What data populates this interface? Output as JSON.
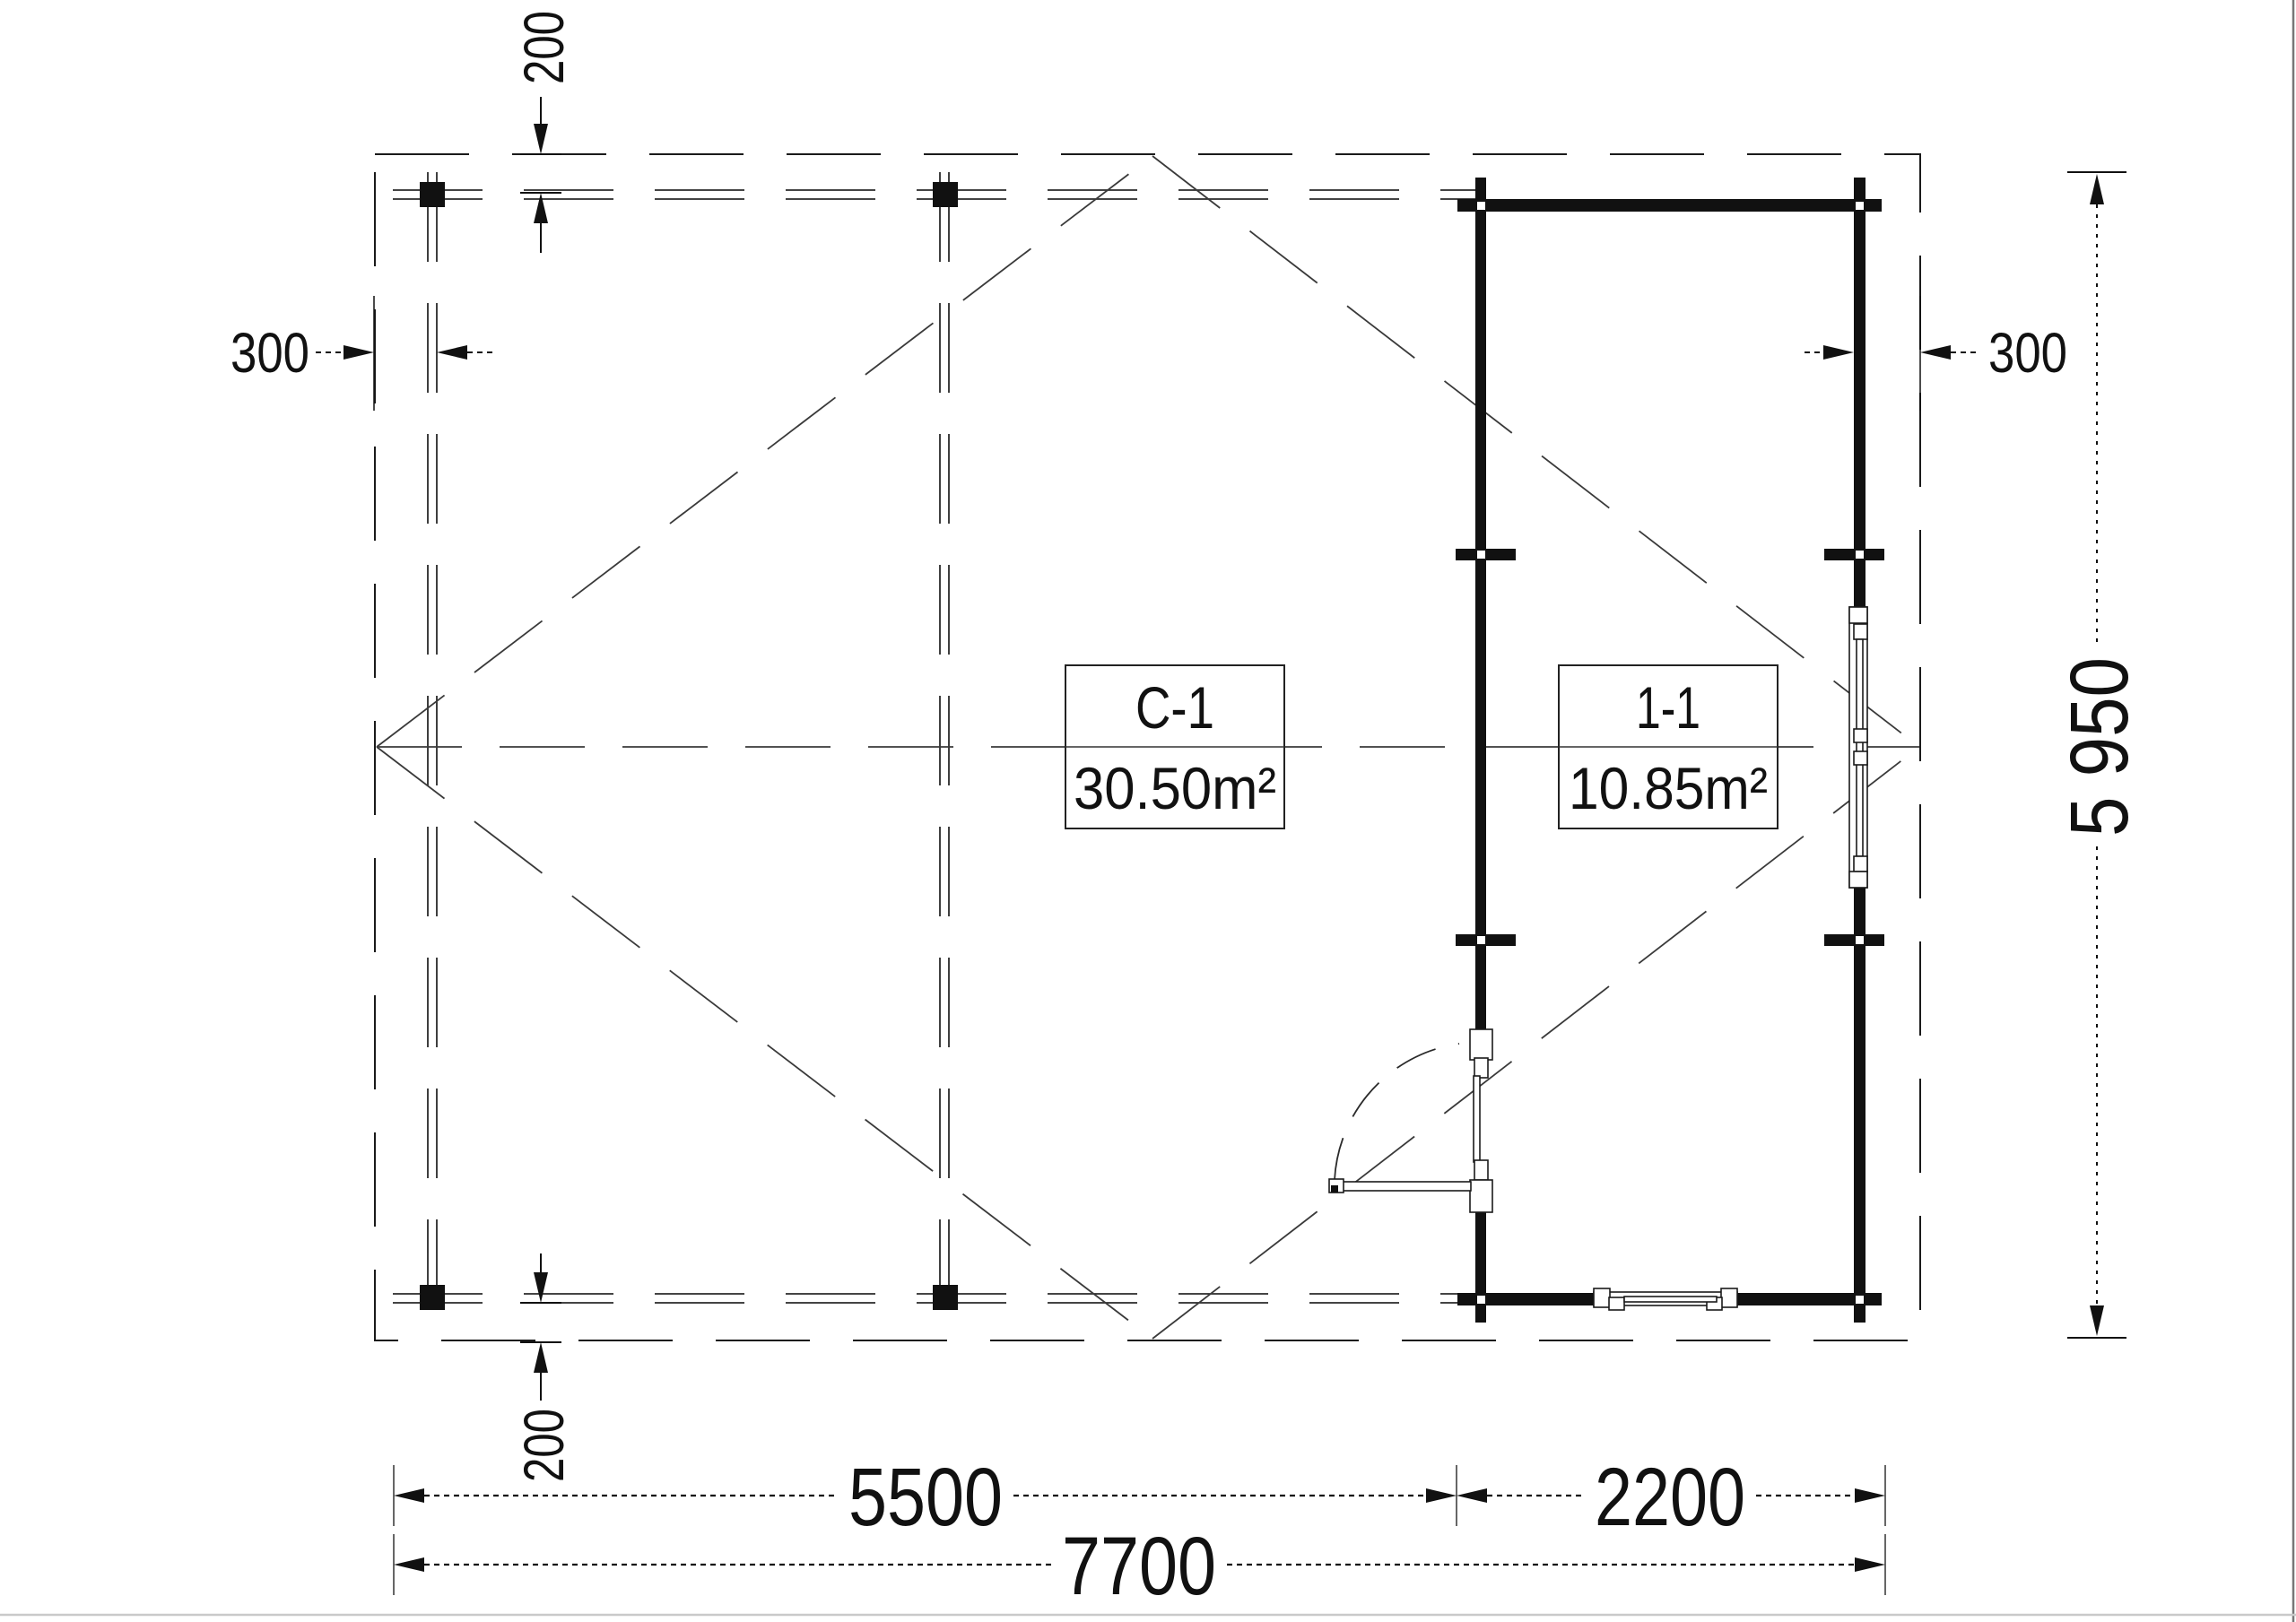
{
  "drawing": {
    "kind": "floor-plan",
    "rooms": [
      {
        "id": "c1",
        "name": "C-1",
        "area": "30.50m²"
      },
      {
        "id": "r11",
        "name": "1-1",
        "area": "10.85m²"
      }
    ],
    "dimensions": {
      "top_offset": "200",
      "bottom_offset": "200",
      "left_overhang": "300",
      "right_overhang": "300",
      "total_height": "5 950",
      "span_left": "5500",
      "span_right": "2200",
      "span_total": "7700"
    },
    "colors": {
      "ink": "#111111",
      "thin_line": "#3a3a3a",
      "page_edge_right": "#777777",
      "page_edge_bottom": "#c9c9c9",
      "background": "#ffffff"
    }
  }
}
